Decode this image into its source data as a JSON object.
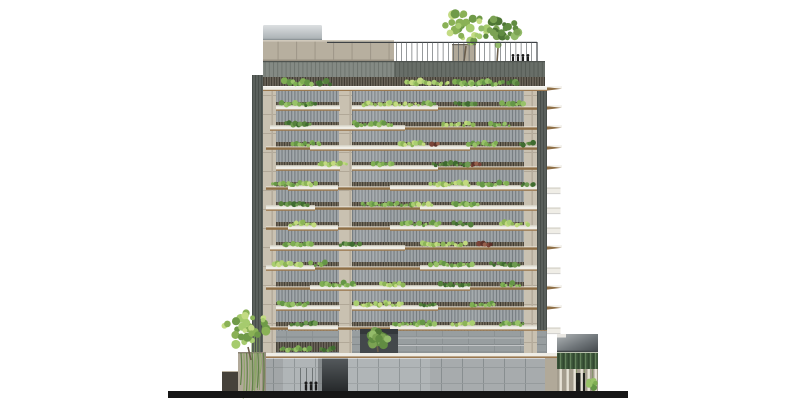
{
  "palette": {
    "background": "#ffffff",
    "ground_black": "#161616",
    "figure": "#1c1c1c",
    "concrete_pier": "#c9c1b1",
    "parapet_concrete": "#b7af9f",
    "slab_white": "#efede6",
    "slab_top_face": "#d9d6ca",
    "slab_brown_edge": "#9b7950",
    "brown_wedge": "#8f6f46",
    "wedge_top_light": "#e9e5da",
    "glazing_gray": "#9aa0a3",
    "rail_base": "#776f60",
    "dark_band": "#686e68",
    "annex_tan": "#b1a999",
    "annex_wall_dark": "#46423b",
    "screen_green": "#3c5539",
    "trunk_brown": "#6b5d4a",
    "greens": {
      "light": [
        "#a9ce70",
        "#8cb457",
        "#c2da7f"
      ],
      "mid": [
        "#7fae53",
        "#659646",
        "#98c268"
      ],
      "dark": [
        "#55803c",
        "#3f6b30",
        "#6d9a50"
      ],
      "deep": [
        "#3f6b30",
        "#2f5526",
        "#55803c"
      ],
      "red": [
        "#7a4438",
        "#5e332a",
        "#96604c"
      ],
      "yellow": [
        "#c9da72",
        "#aec35f",
        "#e0eb9a"
      ]
    },
    "tree_light": [
      "#a6cb6e",
      "#8ab156",
      "#c3db83",
      "#6f9a48"
    ],
    "tree_dark": [
      "#7ba253",
      "#618c42",
      "#4e7635",
      "#93bb6a"
    ]
  },
  "ground": {
    "x": 168,
    "y": 391,
    "w": 460,
    "h": 7
  },
  "roof": {
    "metal_box": {
      "x": 263,
      "y": 25,
      "w": 59,
      "h": 15
    },
    "parapet": {
      "x": 263,
      "y": 40,
      "w": 131,
      "h": 21
    },
    "planter_block": {
      "x": 452,
      "y": 44,
      "w": 24,
      "h": 18
    },
    "railing": {
      "x1": 327,
      "x2": 537,
      "y": 42,
      "post_from": 396,
      "post_step": 5.2,
      "post_h": 19.5
    },
    "trees": [
      {
        "cx": 467,
        "cy": 27,
        "rx": 24,
        "ry": 17,
        "tone": "tree_light",
        "trunk": [
          466,
          46,
          464,
          61
        ]
      },
      {
        "cx": 500,
        "cy": 31,
        "rx": 19,
        "ry": 14,
        "tone": "tree_dark",
        "trunk": [
          498,
          48,
          497,
          62
        ]
      }
    ],
    "people_x": [
      513,
      518,
      523,
      528
    ],
    "people_base": 62,
    "people_h": 8
  },
  "top_band": {
    "y": 61,
    "h": 25,
    "left_x": 263,
    "left_w": 131,
    "right_x": 394,
    "right_w": 151,
    "tick_y": 77,
    "tick_h": 9,
    "slab": {
      "x": 263,
      "y": 86.5,
      "w": 284,
      "h": 4.8
    },
    "plants": [
      [
        284,
        28,
        "mid"
      ],
      [
        316,
        15,
        "dark"
      ],
      [
        404,
        46,
        "light"
      ],
      [
        454,
        50,
        "mid"
      ],
      [
        507,
        13,
        "dark"
      ]
    ]
  },
  "facade": {
    "x": 263,
    "w": 284,
    "y": 91,
    "floor_h": 20,
    "n_floors": 12,
    "piers": [
      {
        "x": 263,
        "w": 13
      },
      {
        "x": 339,
        "w": 13
      },
      {
        "x": 524,
        "w": 13
      }
    ],
    "slivers": [
      {
        "x": 252,
        "w": 11,
        "y0": 75,
        "y1": 352
      },
      {
        "x": 537,
        "w": 10,
        "y0": 91,
        "y1": 330
      }
    ],
    "fin": {
      "x": 547,
      "len": 15,
      "box_w": 13.5,
      "box_h": 6
    },
    "cells": [
      {
        "white": [
          [
            276,
            64
          ],
          [
            352,
            86
          ]
        ],
        "brown": [
          [
            438,
            109
          ]
        ],
        "fin": "brown",
        "plants": [
          [
            278,
            34,
            "mid"
          ],
          [
            302,
            16,
            "dark"
          ],
          [
            362,
            58,
            "light"
          ],
          [
            420,
            16,
            "mid"
          ],
          [
            455,
            22,
            "dark"
          ],
          [
            500,
            26,
            "mid"
          ]
        ]
      },
      {
        "white": [
          [
            270,
            135
          ]
        ],
        "brown": [
          [
            405,
            142
          ]
        ],
        "fin": "brown",
        "plants": [
          [
            285,
            26,
            "dark"
          ],
          [
            352,
            40,
            "mid"
          ],
          [
            440,
            34,
            "light"
          ],
          [
            490,
            20,
            "mid"
          ]
        ]
      },
      {
        "white": [
          [
            310,
            160
          ]
        ],
        "brown": [
          [
            266,
            44
          ],
          [
            470,
            77
          ]
        ],
        "fin": "brown",
        "plants": [
          [
            292,
            30,
            "mid"
          ],
          [
            398,
            26,
            "light"
          ],
          [
            430,
            10,
            "red"
          ],
          [
            468,
            30,
            "mid"
          ],
          [
            520,
            14,
            "dark"
          ]
        ]
      },
      {
        "white": [
          [
            276,
            64
          ],
          [
            352,
            86
          ]
        ],
        "brown": [
          [
            438,
            109
          ]
        ],
        "fin": "brown",
        "plants": [
          [
            318,
            30,
            "light"
          ],
          [
            372,
            22,
            "mid"
          ],
          [
            432,
            36,
            "dark"
          ],
          [
            470,
            12,
            "red"
          ]
        ]
      },
      {
        "white": [
          [
            288,
            50
          ],
          [
            390,
            157
          ]
        ],
        "brown": [
          [
            266,
            22
          ],
          [
            338,
            52
          ]
        ],
        "fin": "white",
        "plants": [
          [
            272,
            36,
            "mid"
          ],
          [
            302,
            14,
            "light"
          ],
          [
            430,
            40,
            "light"
          ],
          [
            478,
            30,
            "mid"
          ],
          [
            520,
            16,
            "dark"
          ]
        ]
      },
      {
        "white": [
          [
            266,
            49
          ],
          [
            420,
            127
          ]
        ],
        "brown": [
          [
            315,
            105
          ]
        ],
        "fin": "white",
        "plants": [
          [
            280,
            30,
            "dark"
          ],
          [
            360,
            52,
            "mid"
          ],
          [
            412,
            20,
            "light"
          ],
          [
            452,
            26,
            "mid"
          ]
        ]
      },
      {
        "white": [
          [
            288,
            50
          ],
          [
            390,
            157
          ]
        ],
        "brown": [
          [
            266,
            22
          ],
          [
            338,
            52
          ]
        ],
        "fin": "white",
        "plants": [
          [
            290,
            26,
            "light"
          ],
          [
            400,
            40,
            "mid"
          ],
          [
            452,
            20,
            "dark"
          ],
          [
            500,
            30,
            "light"
          ]
        ]
      },
      {
        "white": [
          [
            270,
            135
          ]
        ],
        "brown": [
          [
            405,
            142
          ]
        ],
        "fin": "brown",
        "plants": [
          [
            282,
            30,
            "mid"
          ],
          [
            340,
            20,
            "dark"
          ],
          [
            420,
            46,
            "light"
          ],
          [
            478,
            14,
            "red"
          ]
        ]
      },
      {
        "white": [
          [
            266,
            49
          ],
          [
            420,
            127
          ]
        ],
        "brown": [
          [
            315,
            105
          ]
        ],
        "fin": "white",
        "plants": [
          [
            272,
            30,
            "light"
          ],
          [
            310,
            16,
            "mid"
          ],
          [
            430,
            44,
            "mid"
          ],
          [
            490,
            30,
            "dark"
          ]
        ]
      },
      {
        "white": [
          [
            310,
            160
          ]
        ],
        "brown": [
          [
            266,
            44
          ],
          [
            470,
            77
          ]
        ],
        "fin": "brown",
        "plants": [
          [
            320,
            36,
            "mid"
          ],
          [
            380,
            24,
            "light"
          ],
          [
            440,
            30,
            "dark"
          ],
          [
            500,
            20,
            "mid"
          ]
        ]
      },
      {
        "white": [
          [
            276,
            64
          ],
          [
            352,
            86
          ]
        ],
        "brown": [
          [
            438,
            109
          ]
        ],
        "fin": "brown",
        "plants": [
          [
            278,
            32,
            "mid"
          ],
          [
            356,
            48,
            "light"
          ],
          [
            420,
            18,
            "dark"
          ],
          [
            470,
            26,
            "mid"
          ]
        ]
      },
      {
        "white": [
          [
            288,
            50
          ],
          [
            390,
            157
          ]
        ],
        "brown": [
          [
            266,
            22
          ],
          [
            338,
            52
          ]
        ],
        "fin": "white",
        "plants": [
          [
            290,
            28,
            "dark"
          ],
          [
            392,
            44,
            "mid"
          ],
          [
            452,
            22,
            "light"
          ],
          [
            500,
            24,
            "mid"
          ]
        ]
      }
    ]
  },
  "podium": {
    "mezz": {
      "x": 263,
      "y": 331,
      "w": 284,
      "h": 22
    },
    "mezz_lines_y": [
      337.5,
      345
    ],
    "bay1_rail": {
      "x": 276,
      "y": 342,
      "w": 63,
      "h": 10
    },
    "mezz_plants": [
      [
        280,
        32,
        "mid"
      ],
      [
        320,
        15,
        "dark"
      ]
    ],
    "dark_panel": {
      "x": 360,
      "y": 329,
      "w": 38,
      "h": 24
    },
    "panel_tree": {
      "cx": 378,
      "cy": 338,
      "rx": 10,
      "ry": 8,
      "tone": "tree_dark",
      "trunk": [
        377,
        344,
        378,
        352
      ]
    },
    "slab2": {
      "x": 263,
      "y": 353,
      "w": 297,
      "h": 5
    },
    "glass": {
      "x": 263,
      "y": 358.5,
      "w": 284,
      "h": 32.5
    },
    "core": {
      "x": 322,
      "y": 358.5,
      "w": 26,
      "h": 32.5
    },
    "door_mullions_x": [
      300,
      306,
      312
    ],
    "people_x": [
      306,
      311,
      316
    ],
    "people_base": 390.5,
    "people_h": 9
  },
  "left_annex": {
    "wall": {
      "x": 222,
      "y": 372,
      "w": 26,
      "h": 19
    },
    "planter": {
      "x": 238,
      "y": 352,
      "w": 28,
      "h": 39
    },
    "tree": {
      "cx": 246,
      "cy": 329,
      "rx": 23,
      "ry": 18,
      "tone": "tree_light",
      "trunk": [
        248,
        347,
        251,
        360
      ]
    },
    "cascade": {
      "x": 241,
      "y": 353,
      "n": 9,
      "max_len": 32
    },
    "bamboo": {
      "x": 252,
      "y0": 332,
      "y1": 390,
      "n": 4
    }
  },
  "right_annex": {
    "connector": {
      "x": 545,
      "y": 358,
      "w": 12,
      "h": 33
    },
    "roof": {
      "x": 557,
      "y": 334,
      "w": 41,
      "h": 18
    },
    "roof_notch": {
      "x": 557,
      "y": 334,
      "w": 9,
      "h": 3.5
    },
    "screen": {
      "x": 557,
      "y": 352,
      "w": 41,
      "h": 17
    },
    "column_band": {
      "x": 557,
      "y": 369,
      "w": 41,
      "h": 22
    },
    "columns_x": [
      559.5,
      566.5,
      573.5,
      580.5,
      587.5,
      594.5
    ],
    "door": {
      "x": 575,
      "y": 373,
      "w": 10,
      "h": 18
    },
    "person": {
      "x": 578,
      "base": 390.5,
      "h": 8.5
    },
    "shrub": {
      "cx": 592,
      "base": 391
    }
  }
}
